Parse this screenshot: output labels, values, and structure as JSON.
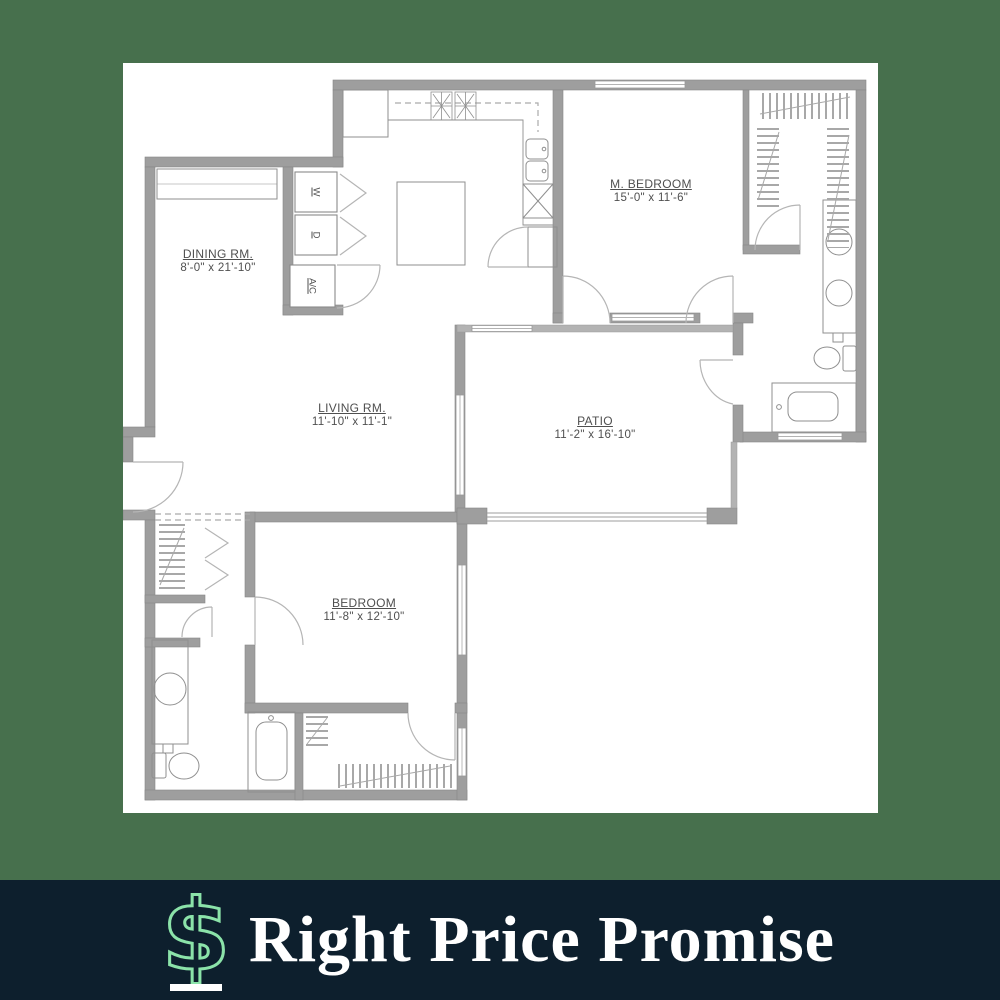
{
  "image": {
    "type": "floor-plan-marketing-graphic"
  },
  "floor_plan": {
    "rooms": [
      {
        "name": "DINING RM.",
        "dims": "8'-0\" x 21'-10\""
      },
      {
        "name": "M. BEDROOM",
        "dims": "15'-0\" x 11'-6\""
      },
      {
        "name": "LIVING RM.",
        "dims": "11'-10\" x 11'-1\""
      },
      {
        "name": "PATIO",
        "dims": "11'-2\" x 16'-10\""
      },
      {
        "name": "BEDROOM",
        "dims": "11'-8\" x 12'-10\""
      }
    ],
    "utility_labels": [
      {
        "label": "W"
      },
      {
        "label": "D"
      },
      {
        "label": "A/C"
      }
    ]
  },
  "footer": {
    "title": "Right Price Promise",
    "icon": "dollar-sign",
    "icon_glyph": "$"
  },
  "colors": {
    "frame_green": "#47704D",
    "footer_navy": "#0D1F2D",
    "accent_mint": "#8BE3A9",
    "plan_wall_gray": "#9E9E9E",
    "plan_text_gray": "#4F4F4F",
    "panel_white": "#FFFFFF"
  }
}
